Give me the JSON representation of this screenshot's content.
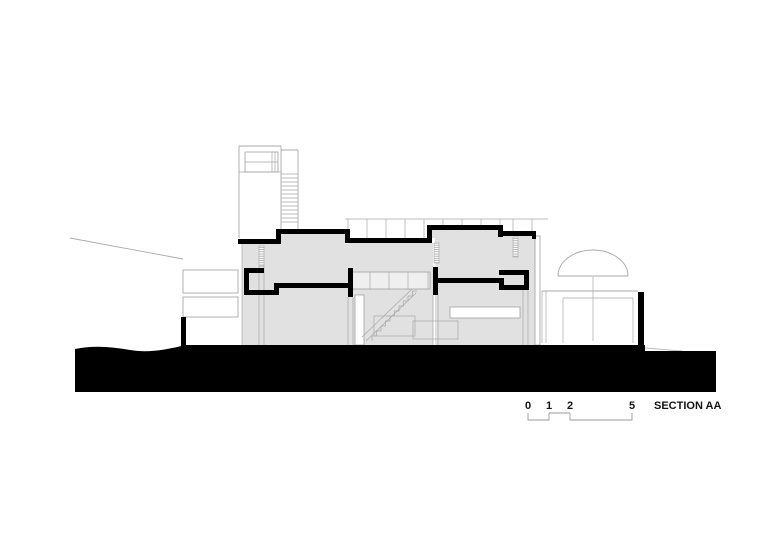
{
  "drawing": {
    "title": "SECTION AA",
    "type": "architectural-section",
    "scale_bar": {
      "labels": [
        "0",
        "1",
        "2",
        "5"
      ]
    }
  },
  "colors": {
    "background": "#ffffff",
    "fill_gray": "#e1e1e1",
    "line_gray": "#a8a8a8",
    "cut_black": "#000000",
    "band_light": "#efefef",
    "text_color": "#141414"
  }
}
